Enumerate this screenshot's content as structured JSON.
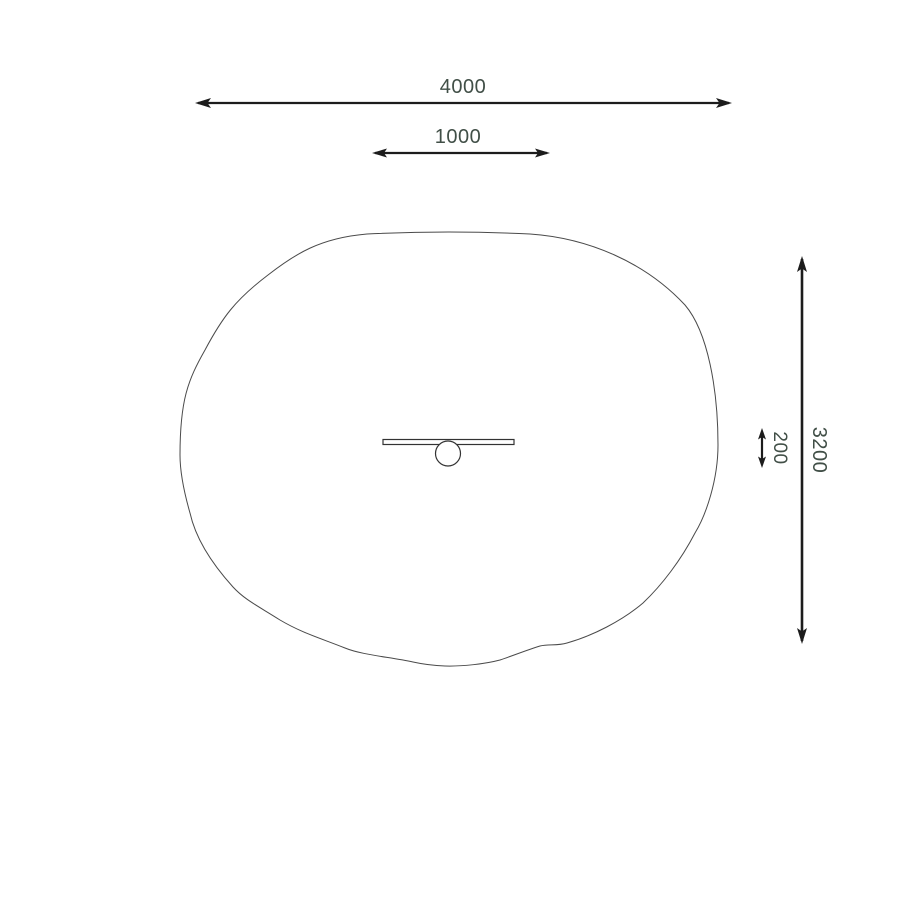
{
  "drawing": {
    "type": "plan-view technical drawing of play equipment with safety zone",
    "labels": {
      "width": "4000",
      "inner_width": "1000",
      "height": "3200",
      "inner_height": "200"
    },
    "colors": {
      "background": "#ffffff",
      "dimension_line": "#1c1c1c",
      "label_text": "#414f47",
      "zone_outline": "#4a4a4a",
      "detail_outline": "#333333"
    }
  }
}
